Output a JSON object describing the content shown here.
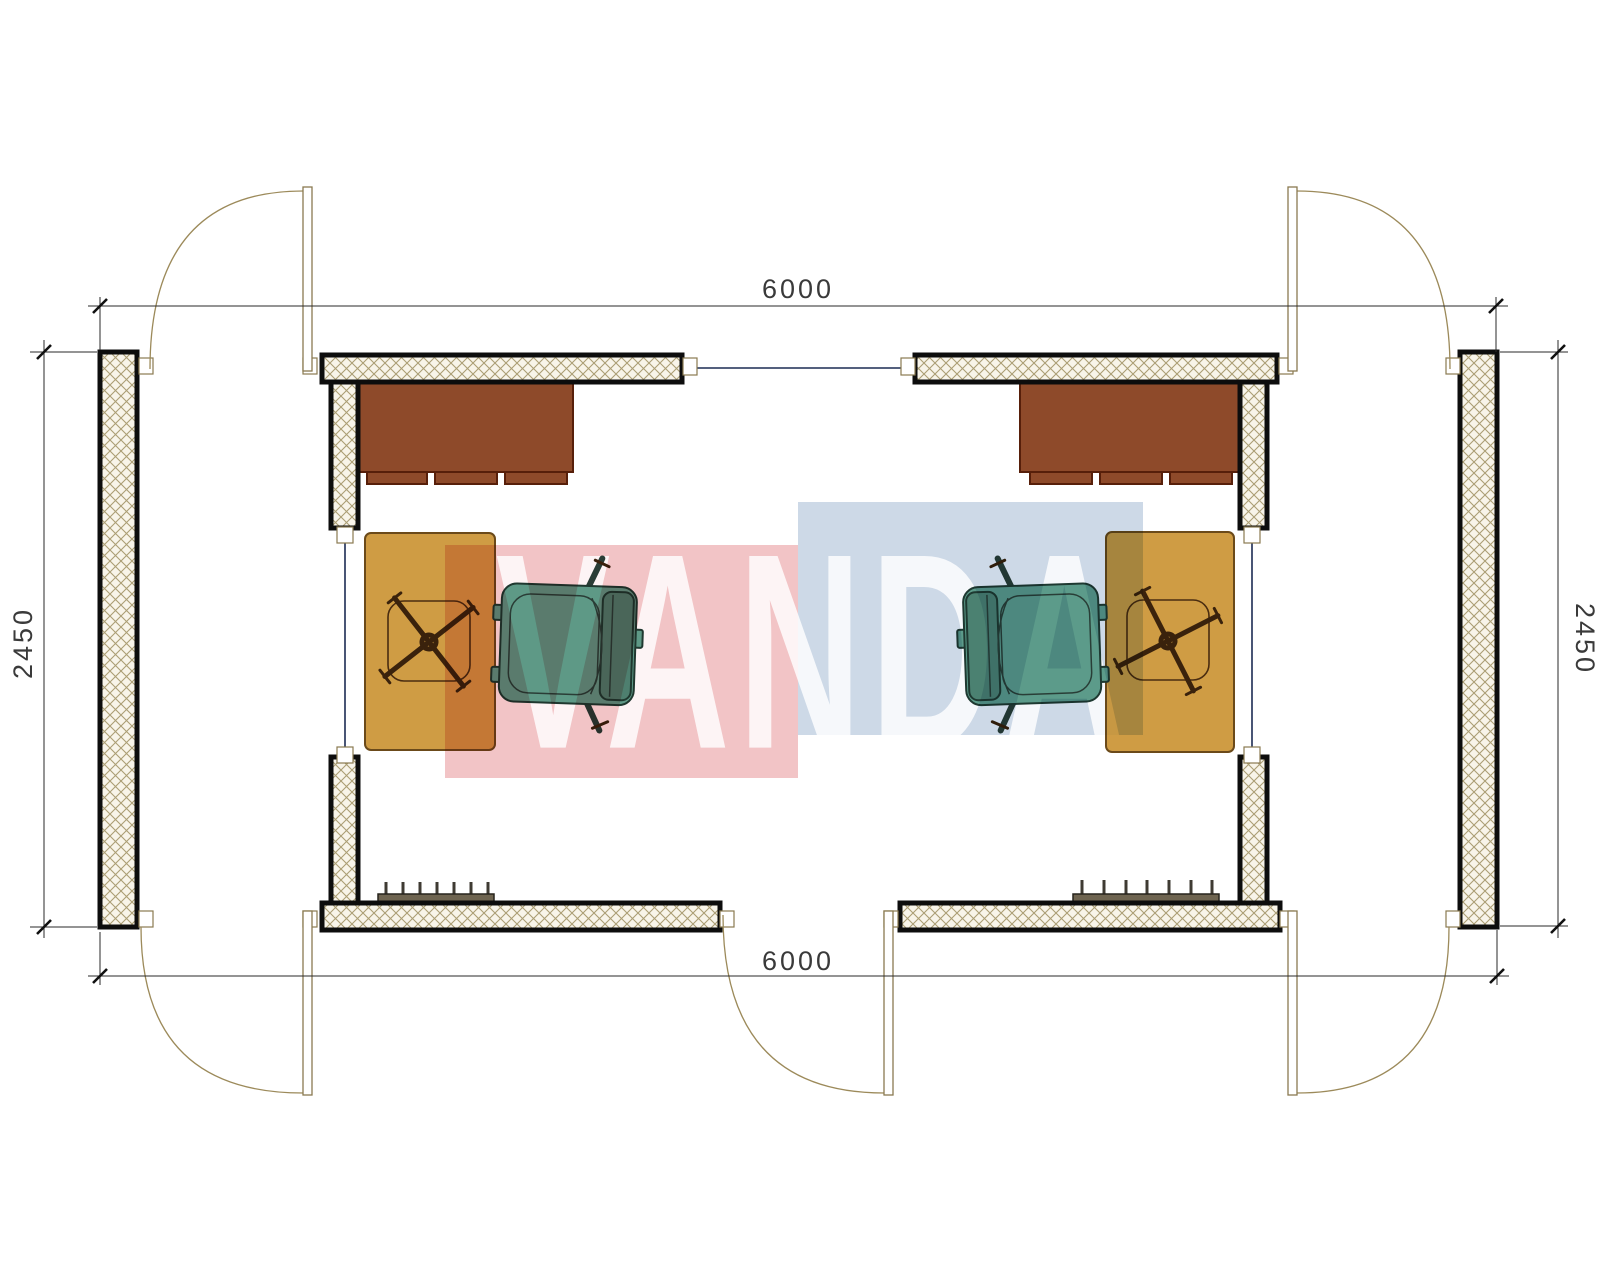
{
  "title": "modular-office-floor-plan",
  "dimensions": {
    "top": "6000",
    "bottom": "6000",
    "left": "2450",
    "right": "2450"
  },
  "watermark": {
    "text": "VANDA",
    "pink_color": "#f2c4c6",
    "blue_color": "#cdd9e7"
  },
  "colors": {
    "wall_fill": "#f8f4e9",
    "wall_hatch": "#ab9e74",
    "window_line": "#1c2b53",
    "desk": "#8e4a2a",
    "table": "#cf9c44",
    "chair_body": "#5fa08c",
    "chair_seat": "#6aab94",
    "chair_back": "#4e8573",
    "radiator": "#6e6450"
  }
}
